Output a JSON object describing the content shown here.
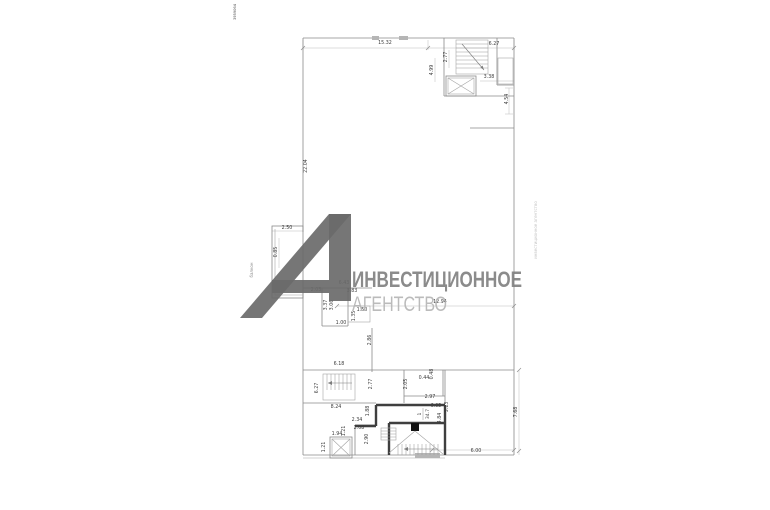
{
  "page": {
    "background": "#ffffff"
  },
  "watermark": {
    "line1": "ИНВЕСТИЦИОННОЕ",
    "line2": "АГЕНТСТВО",
    "logo_color": "#6a6a6a",
    "line1_color": "#7f7f7f",
    "line2_color": "#b4b4b4"
  },
  "annotations": {
    "top_left_vertical": "3959064",
    "right_vertical": "инвестиционное агентство",
    "balcony_vertical": "балкон"
  },
  "plan": {
    "line_color": "#8a8a8a",
    "thick_wall_color": "#3f3f3f",
    "dim_text_color": "#3c3c3c",
    "room_area_label": {
      "num": "1",
      "den": "34.7"
    },
    "dimensions": [
      {
        "t": "15.32",
        "x": 385,
        "y": 44
      },
      {
        "t": "2.77",
        "x": 447,
        "y": 57,
        "r": 1
      },
      {
        "t": "6.27",
        "x": 494,
        "y": 45
      },
      {
        "t": "4.99",
        "x": 433,
        "y": 70,
        "r": 1
      },
      {
        "t": "3.38",
        "x": 489,
        "y": 78
      },
      {
        "t": "4.54",
        "x": 508,
        "y": 99,
        "r": 1
      },
      {
        "t": "22.04",
        "x": 307,
        "y": 166,
        "r": 1
      },
      {
        "t": "2.50",
        "x": 287,
        "y": 229
      },
      {
        "t": "0.85",
        "x": 277,
        "y": 252,
        "r": 1
      },
      {
        "t": "6.43",
        "x": 344,
        "y": 284
      },
      {
        "t": "2.03",
        "x": 316,
        "y": 291
      },
      {
        "t": "3.83",
        "x": 352,
        "y": 292
      },
      {
        "t": "3.37",
        "x": 327,
        "y": 305,
        "r": 1
      },
      {
        "t": "3.06",
        "x": 333,
        "y": 305,
        "r": 1
      },
      {
        "t": "1.50",
        "x": 362,
        "y": 311
      },
      {
        "t": "1.35",
        "x": 355,
        "y": 316,
        "r": 1
      },
      {
        "t": "1.00",
        "x": 341,
        "y": 324
      },
      {
        "t": "12.94",
        "x": 440,
        "y": 303
      },
      {
        "t": "2.86",
        "x": 371,
        "y": 340,
        "r": 1
      },
      {
        "t": "6.18",
        "x": 339,
        "y": 365
      },
      {
        "t": "6.27",
        "x": 318,
        "y": 388,
        "r": 1
      },
      {
        "t": "2.77",
        "x": 372,
        "y": 384,
        "r": 1
      },
      {
        "t": "2.05",
        "x": 407,
        "y": 384,
        "r": 1
      },
      {
        "t": "0.44",
        "x": 424,
        "y": 379
      },
      {
        "t": "0.48",
        "x": 433,
        "y": 374,
        "r": 1
      },
      {
        "t": "8.24",
        "x": 336,
        "y": 408
      },
      {
        "t": "1.88",
        "x": 369,
        "y": 411,
        "r": 1
      },
      {
        "t": "2.34",
        "x": 357,
        "y": 421
      },
      {
        "t": "2.97",
        "x": 430,
        "y": 398
      },
      {
        "t": "2.08",
        "x": 359,
        "y": 429
      },
      {
        "t": "1.21",
        "x": 345,
        "y": 431,
        "r": 1
      },
      {
        "t": "6.05",
        "x": 436,
        "y": 407
      },
      {
        "t": "5.13",
        "x": 448,
        "y": 407,
        "r": 1
      },
      {
        "t": "1.94",
        "x": 337,
        "y": 435
      },
      {
        "t": "2.90",
        "x": 368,
        "y": 439,
        "r": 1
      },
      {
        "t": "4.84",
        "x": 441,
        "y": 418,
        "r": 1
      },
      {
        "t": "1.21",
        "x": 325,
        "y": 447,
        "r": 1
      },
      {
        "t": "6.00",
        "x": 476,
        "y": 452
      },
      {
        "t": "7.68",
        "x": 517,
        "y": 412,
        "r": 1
      }
    ]
  }
}
